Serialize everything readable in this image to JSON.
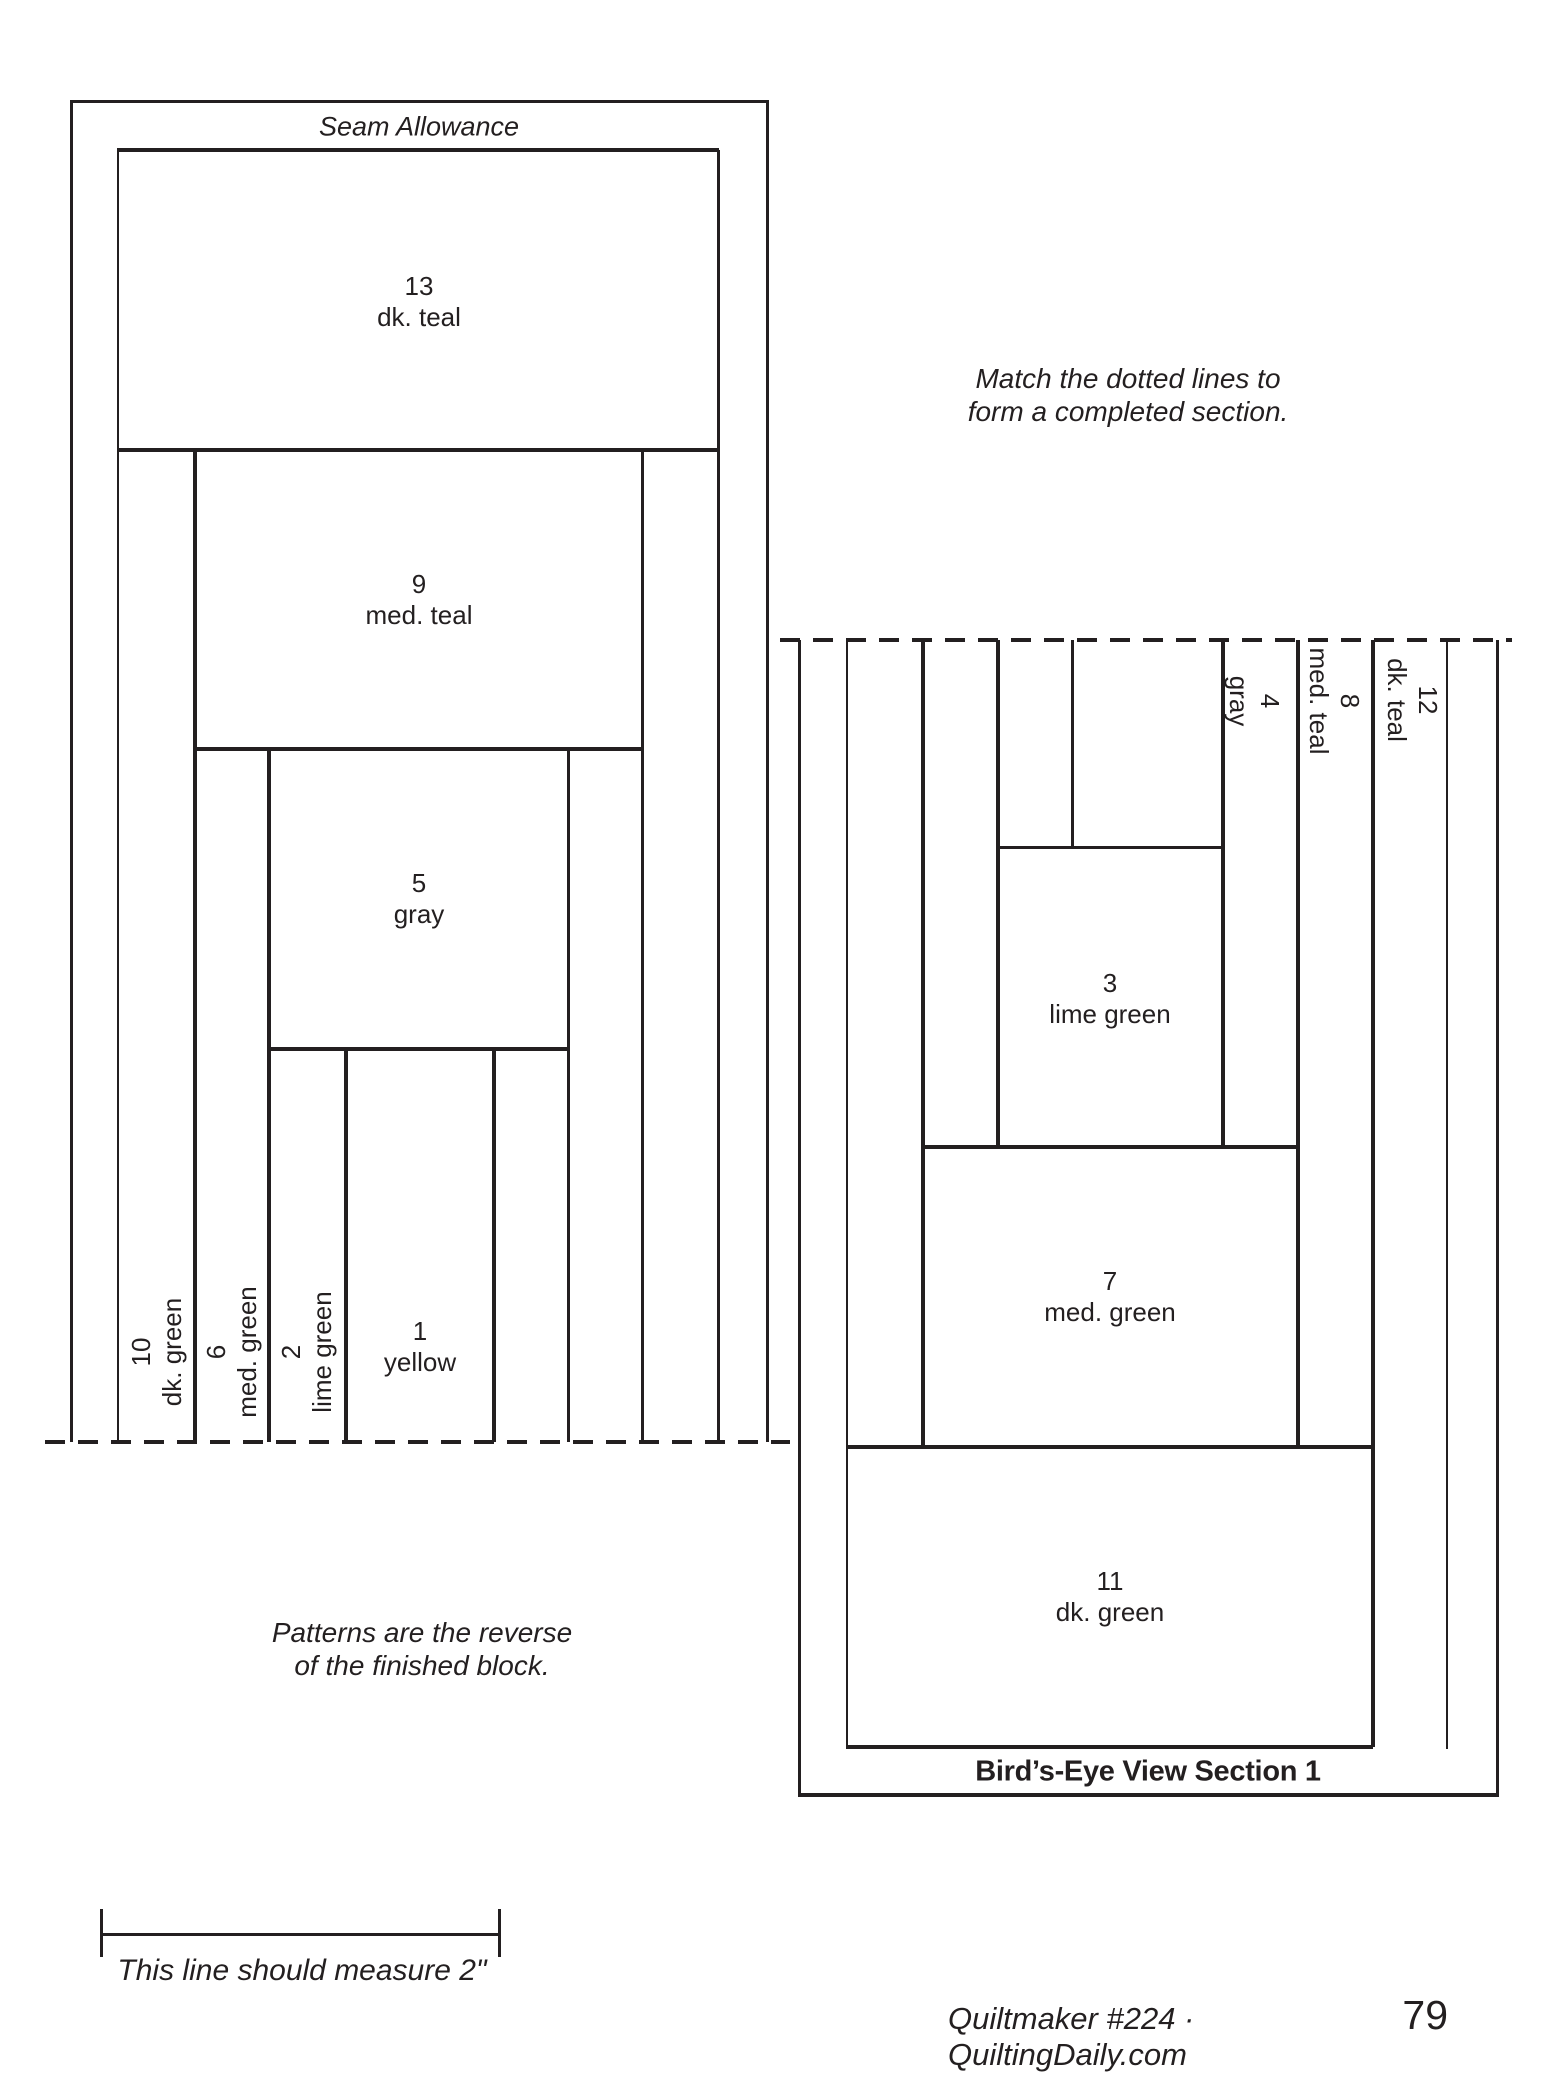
{
  "seam_allowance_label": "Seam Allowance",
  "left_pattern": {
    "pieces": {
      "p13": {
        "number": "13",
        "color": "dk. teal"
      },
      "p9": {
        "number": "9",
        "color": "med. teal"
      },
      "p5": {
        "number": "5",
        "color": "gray"
      },
      "p1": {
        "number": "1",
        "color": "yellow"
      },
      "p2": {
        "number": "2",
        "color": "lime green"
      },
      "p6": {
        "number": "6",
        "color": "med. green"
      },
      "p10": {
        "number": "10",
        "color": "dk. green"
      }
    }
  },
  "birdseye_pattern": {
    "caption": "Bird’s-Eye View Section 1",
    "pieces": {
      "p3": {
        "number": "3",
        "color": "lime green"
      },
      "p7": {
        "number": "7",
        "color": "med. green"
      },
      "p11": {
        "number": "11",
        "color": "dk. green"
      },
      "p4": {
        "number": "4",
        "color": "gray"
      },
      "p8": {
        "number": "8",
        "color": "med. teal"
      },
      "p12": {
        "number": "12",
        "color": "dk. teal"
      }
    }
  },
  "notes": {
    "match_line1": "Match the dotted lines to",
    "match_line2": "form a completed section.",
    "reverse_line1": "Patterns are the reverse",
    "reverse_line2": "of the finished block.",
    "measure": "This line should measure 2\""
  },
  "footer": {
    "credit": "Quiltmaker #224 · QuiltingDaily.com",
    "page_number": "79"
  },
  "colors": {
    "ink": "#231f20",
    "paper": "#ffffff"
  }
}
